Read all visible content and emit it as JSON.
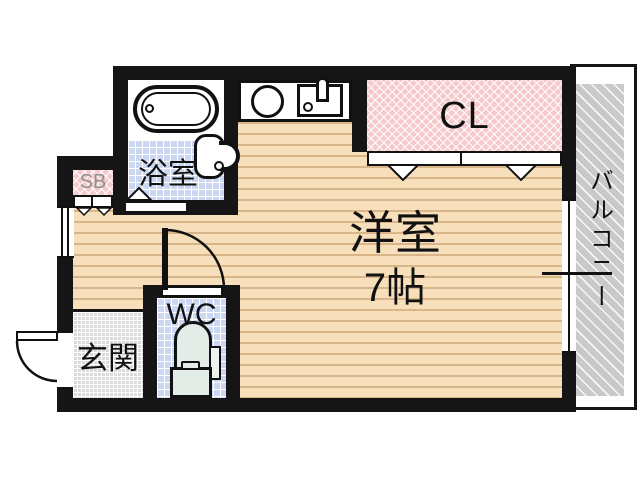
{
  "floorplan": {
    "main_room": {
      "name": "洋室",
      "size": "7帖"
    },
    "closet_label": "CL",
    "balcony_label": "バルコニー",
    "bathroom_label": "浴室",
    "wc_label": "WC",
    "entrance_label": "玄関",
    "shoebox_label": "SB",
    "colors": {
      "wall": "#151515",
      "wood_floor": "#f6dfba",
      "wood_grain_line": "#d9b58a",
      "wet_area_tile": "#ccd7f2",
      "closet_pink": "#f6c9cd",
      "balcony_gray": "#c9c9c9",
      "entrance_gray": "#dadada",
      "toilet_fixture": "#e3ece6"
    },
    "icons": {
      "bathtub": "double-outline rounded rectangle with drain circle",
      "washbasin": "rounded basin with faucet hook and drain circle",
      "stove_burner": "circle outline",
      "kitchen_sink": "rectangle with drain circle and faucet",
      "toilet": "tank with bowl, handle and side panel",
      "door_triangle": "white triangle opening marker",
      "door_arc": "quarter-circle swing arc",
      "window": "double-line opening in wall"
    }
  }
}
